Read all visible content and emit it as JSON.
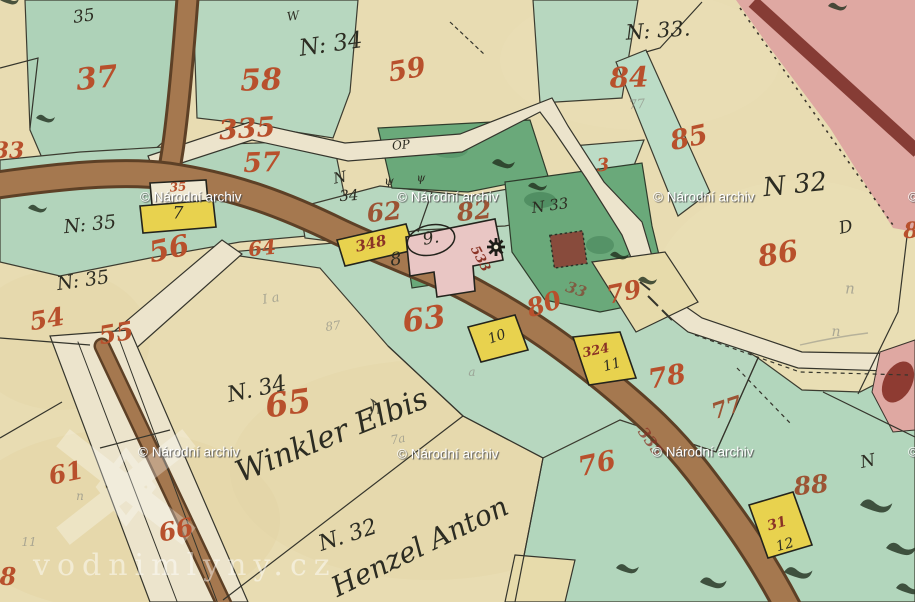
{
  "title": "Historical cadastral map sheet (hand-drawn, watercoloured)",
  "colors": {
    "paper": "#e8dcb2",
    "green_light": "#b7d7bf",
    "green_dark": "#6aa97a",
    "path_white": "#ece4cc",
    "road_brown": "#a5784f",
    "road_brown_edge": "#5d4026",
    "road_pink": "#dfa8a2",
    "stripe_darkred": "#7e332b",
    "house_yellow": "#e8d24e",
    "house_pink": "#e9c6c4",
    "building_red": "#8e3b32",
    "label_red": "#b8502c",
    "label_ink": "#2c2c22",
    "pencil": "#8f9086",
    "watermark_white": "#ffffff"
  },
  "watermarks": {
    "archive": {
      "text": "© Národní archiv",
      "positions": [
        [
          140,
          197
        ],
        [
          397,
          197
        ],
        [
          653,
          197
        ],
        [
          908,
          197
        ],
        [
          138,
          452
        ],
        [
          397,
          454
        ],
        [
          652,
          452
        ],
        [
          908,
          452
        ]
      ]
    },
    "site": {
      "text": "vodnimlyny.cz",
      "x": 33,
      "y": 548
    }
  },
  "labels": [
    {
      "text": "37",
      "x": 97,
      "y": 79,
      "size": 30,
      "rot": -6,
      "cls": "red"
    },
    {
      "text": "58",
      "x": 261,
      "y": 81,
      "size": 30,
      "rot": -2,
      "cls": "red"
    },
    {
      "text": "59",
      "x": 407,
      "y": 70,
      "size": 27,
      "rot": -10,
      "cls": "red"
    },
    {
      "text": "84",
      "x": 629,
      "y": 78,
      "size": 28,
      "rot": -2,
      "cls": "red"
    },
    {
      "text": "85",
      "x": 689,
      "y": 138,
      "size": 27,
      "rot": -12,
      "cls": "red"
    },
    {
      "text": "335",
      "x": 247,
      "y": 129,
      "size": 27,
      "rot": -4,
      "cls": "red"
    },
    {
      "text": "57",
      "x": 262,
      "y": 163,
      "size": 27,
      "rot": -2,
      "cls": "red"
    },
    {
      "text": "33",
      "x": 9,
      "y": 151,
      "size": 22,
      "rot": 0,
      "cls": "red"
    },
    {
      "text": "3",
      "x": 603,
      "y": 166,
      "size": 18,
      "rot": -5,
      "cls": "red"
    },
    {
      "text": "86",
      "x": 778,
      "y": 254,
      "size": 29,
      "rot": -10,
      "cls": "red"
    },
    {
      "text": "56",
      "x": 169,
      "y": 249,
      "size": 29,
      "rot": -12,
      "cls": "red"
    },
    {
      "text": "64",
      "x": 262,
      "y": 248,
      "size": 20,
      "rot": -6,
      "cls": "red"
    },
    {
      "text": "54",
      "x": 47,
      "y": 319,
      "size": 25,
      "rot": -10,
      "cls": "red"
    },
    {
      "text": "55",
      "x": 116,
      "y": 333,
      "size": 25,
      "rot": -10,
      "cls": "red"
    },
    {
      "text": "35",
      "x": 178,
      "y": 187,
      "size": 12,
      "rot": -4,
      "cls": "red"
    },
    {
      "text": "62",
      "x": 384,
      "y": 212,
      "size": 25,
      "rot": -6,
      "cls": "brownred"
    },
    {
      "text": "82",
      "x": 474,
      "y": 211,
      "size": 25,
      "rot": -6,
      "cls": "brownred"
    },
    {
      "text": "80",
      "x": 544,
      "y": 304,
      "size": 25,
      "rot": -18,
      "cls": "red"
    },
    {
      "text": "79",
      "x": 624,
      "y": 292,
      "size": 25,
      "rot": -12,
      "cls": "red"
    },
    {
      "text": "78",
      "x": 667,
      "y": 377,
      "size": 27,
      "rot": -10,
      "cls": "red"
    },
    {
      "text": "77",
      "x": 727,
      "y": 408,
      "size": 22,
      "rot": -18,
      "cls": "brownred"
    },
    {
      "text": "63",
      "x": 424,
      "y": 320,
      "size": 31,
      "rot": -8,
      "cls": "red"
    },
    {
      "text": "65",
      "x": 288,
      "y": 403,
      "size": 33,
      "rot": -8,
      "cls": "red"
    },
    {
      "text": "76",
      "x": 597,
      "y": 464,
      "size": 27,
      "rot": -12,
      "cls": "red"
    },
    {
      "text": "88",
      "x": 811,
      "y": 485,
      "size": 25,
      "rot": -6,
      "cls": "brownred"
    },
    {
      "text": "61",
      "x": 66,
      "y": 473,
      "size": 25,
      "rot": -12,
      "cls": "red"
    },
    {
      "text": "66",
      "x": 176,
      "y": 530,
      "size": 25,
      "rot": -12,
      "cls": "red"
    },
    {
      "text": "8",
      "x": 8,
      "y": 577,
      "size": 24,
      "rot": 0,
      "cls": "red"
    },
    {
      "text": "8",
      "x": 911,
      "y": 231,
      "size": 22,
      "rot": 0,
      "cls": "red"
    },
    {
      "text": "533",
      "x": 480,
      "y": 259,
      "size": 13,
      "rot": 62,
      "cls": "darkred"
    },
    {
      "text": "348",
      "x": 371,
      "y": 244,
      "size": 15,
      "rot": -13,
      "cls": "darkred"
    },
    {
      "text": "324",
      "x": 596,
      "y": 351,
      "size": 13,
      "rot": -12,
      "cls": "darkred"
    },
    {
      "text": "31",
      "x": 777,
      "y": 524,
      "size": 14,
      "rot": -16,
      "cls": "darkred"
    },
    {
      "text": "33",
      "x": 576,
      "y": 290,
      "size": 15,
      "rot": 18,
      "cls": "darkred",
      "op": 0.65
    },
    {
      "text": "335",
      "x": 650,
      "y": 442,
      "size": 15,
      "rot": 55,
      "cls": "darkred",
      "op": 0.75
    },
    {
      "text": "N: 34",
      "x": 331,
      "y": 45,
      "size": 23,
      "rot": -8,
      "cls": "ink"
    },
    {
      "text": "N: 33.",
      "x": 658,
      "y": 31,
      "size": 21,
      "rot": -4,
      "cls": "ink"
    },
    {
      "text": "N 32",
      "x": 795,
      "y": 185,
      "size": 26,
      "rot": -6,
      "cls": "ink"
    },
    {
      "text": "D",
      "x": 846,
      "y": 228,
      "size": 17,
      "rot": -12,
      "cls": "ink"
    },
    {
      "text": "N: 35",
      "x": 90,
      "y": 225,
      "size": 19,
      "rot": -6,
      "cls": "ink"
    },
    {
      "text": "N: 35",
      "x": 83,
      "y": 281,
      "size": 19,
      "rot": -8,
      "cls": "ink"
    },
    {
      "text": "7",
      "x": 178,
      "y": 214,
      "size": 17,
      "rot": 0,
      "cls": "ink"
    },
    {
      "text": "8",
      "x": 396,
      "y": 260,
      "size": 18,
      "rot": -8,
      "cls": "ink"
    },
    {
      "text": "9.",
      "x": 431,
      "y": 239,
      "size": 17,
      "rot": -10,
      "cls": "ink"
    },
    {
      "text": "10",
      "x": 497,
      "y": 337,
      "size": 14,
      "rot": -20,
      "cls": "ink"
    },
    {
      "text": "11",
      "x": 612,
      "y": 365,
      "size": 14,
      "rot": -16,
      "cls": "ink"
    },
    {
      "text": "12",
      "x": 785,
      "y": 545,
      "size": 14,
      "rot": -16,
      "cls": "ink"
    },
    {
      "text": "N",
      "x": 340,
      "y": 178,
      "size": 15,
      "rot": -12,
      "cls": "ink"
    },
    {
      "text": "34",
      "x": 349,
      "y": 196,
      "size": 15,
      "rot": -4,
      "cls": "ink"
    },
    {
      "text": "N 33",
      "x": 550,
      "y": 206,
      "size": 15,
      "rot": -8,
      "cls": "ink"
    },
    {
      "text": "OP",
      "x": 401,
      "y": 145,
      "size": 12,
      "rot": -6,
      "cls": "ink"
    },
    {
      "text": "35",
      "x": 84,
      "y": 17,
      "size": 17,
      "rot": -8,
      "cls": "ink"
    },
    {
      "text": "W",
      "x": 293,
      "y": 16,
      "size": 12,
      "rot": -8,
      "cls": "ink"
    },
    {
      "text": "ψ",
      "x": 389,
      "y": 181,
      "size": 12,
      "rot": 0,
      "cls": "ink"
    },
    {
      "text": "ψ",
      "x": 421,
      "y": 178,
      "size": 11,
      "rot": 0,
      "cls": "ink"
    },
    {
      "text": "N. 34",
      "x": 257,
      "y": 390,
      "size": 22,
      "rot": -12,
      "cls": "ink"
    },
    {
      "text": "N. 32",
      "x": 348,
      "y": 536,
      "size": 22,
      "rot": -18,
      "cls": "ink"
    },
    {
      "text": "N",
      "x": 868,
      "y": 462,
      "size": 17,
      "rot": -12,
      "cls": "ink"
    },
    {
      "text": "Winkler Elbis",
      "x": 332,
      "y": 436,
      "size": 30,
      "rot": -22,
      "cls": "ink"
    },
    {
      "text": "Henzel Anton",
      "x": 420,
      "y": 547,
      "size": 28,
      "rot": -26,
      "cls": "ink"
    },
    {
      "text": "77",
      "x": 637,
      "y": 105,
      "size": 13,
      "rot": -5,
      "cls": "pencil"
    },
    {
      "text": "n",
      "x": 850,
      "y": 289,
      "size": 15,
      "rot": 0,
      "cls": "pencil"
    },
    {
      "text": "n",
      "x": 836,
      "y": 332,
      "size": 14,
      "rot": 0,
      "cls": "pencil"
    },
    {
      "text": "I a",
      "x": 271,
      "y": 299,
      "size": 13,
      "rot": -10,
      "cls": "pencil"
    },
    {
      "text": "87",
      "x": 333,
      "y": 326,
      "size": 12,
      "rot": -8,
      "cls": "pencil"
    },
    {
      "text": "11",
      "x": 29,
      "y": 542,
      "size": 12,
      "rot": 0,
      "cls": "pencil"
    },
    {
      "text": "7a",
      "x": 398,
      "y": 439,
      "size": 12,
      "rot": -10,
      "cls": "pencil"
    },
    {
      "text": "a",
      "x": 472,
      "y": 372,
      "size": 12,
      "rot": 0,
      "cls": "pencil"
    },
    {
      "text": "n",
      "x": 80,
      "y": 496,
      "size": 12,
      "rot": 0,
      "cls": "pencil"
    }
  ]
}
